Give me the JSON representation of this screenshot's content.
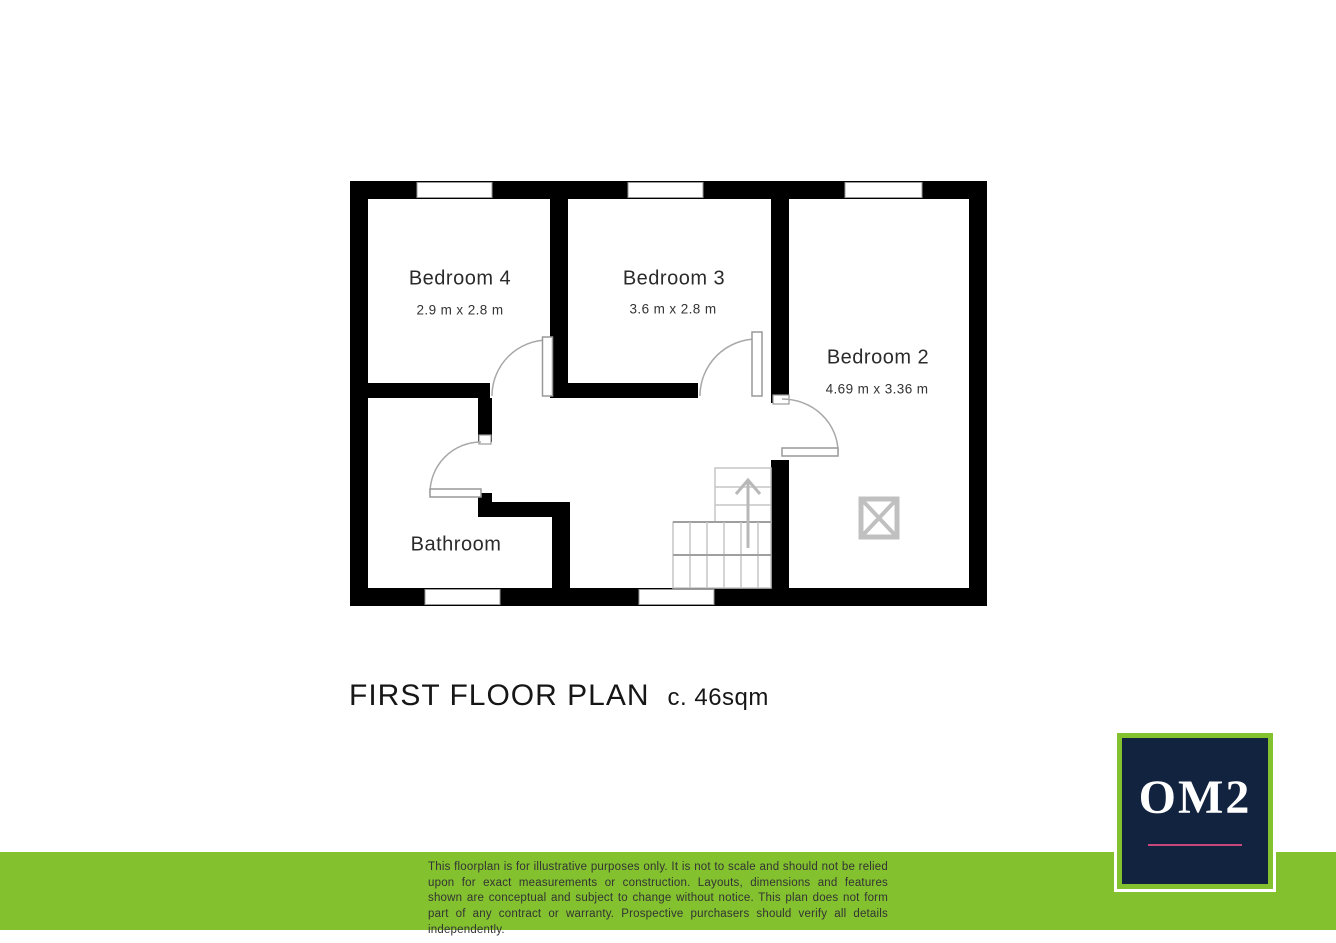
{
  "document": {
    "title": "FIRST FLOOR PLAN",
    "area_label": "c. 46sqm"
  },
  "floorplan": {
    "rooms": [
      {
        "name": "Bedroom 4",
        "dimensions": "2.9 m x 2.8 m"
      },
      {
        "name": "Bedroom 3",
        "dimensions": "3.6 m x 2.8 m"
      },
      {
        "name": "Bedroom 2",
        "dimensions": "4.69 m x 3.36 m"
      },
      {
        "name": "Bathroom",
        "dimensions": ""
      }
    ],
    "features": [
      "stairs-up-arrow",
      "roof-window-symbol"
    ]
  },
  "branding": {
    "logo_text": "OM2"
  },
  "footer": {
    "disclaimer": "This floorplan is for illustrative purposes only. It is not to scale and should not be relied upon for exact measurements or construction. Layouts, dimensions and features shown are conceptual and subject to change without notice. This plan does not form part of any contract or warranty. Prospective purchasers should verify all details independently."
  },
  "colors": {
    "wall": "#000000",
    "accent_green": "#83C12F",
    "navy": "#12233F",
    "pink_underline": "#C8487E",
    "plan_line_gray": "#C0C0C0"
  }
}
